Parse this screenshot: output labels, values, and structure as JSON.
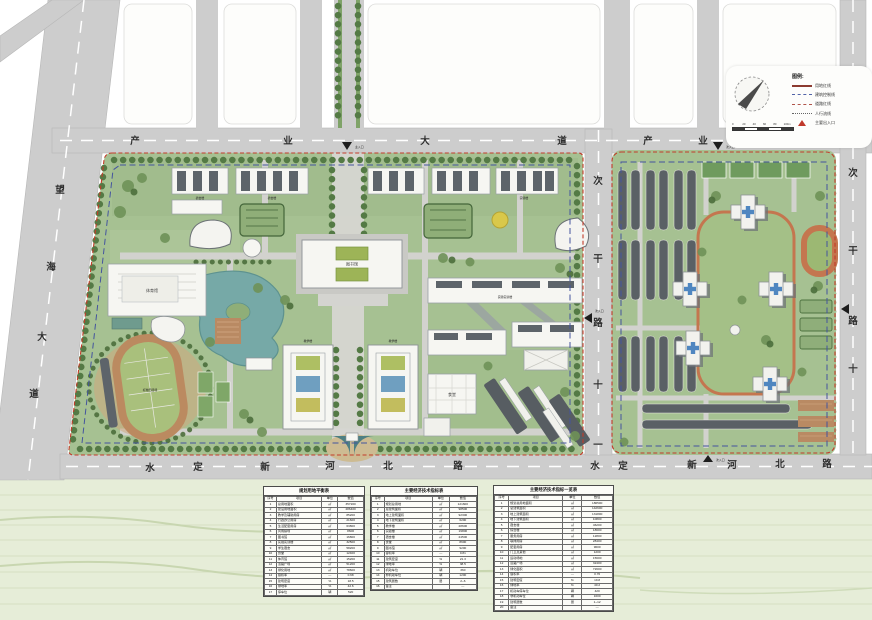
{
  "legend": {
    "title": "图例:",
    "items": [
      {
        "label": "用地红线",
        "type": "solid-red"
      },
      {
        "label": "建筑控制线",
        "type": "dash-blue"
      },
      {
        "label": "道路红线",
        "type": "dash-red"
      },
      {
        "label": "人行流线",
        "type": "dot-gray"
      },
      {
        "label": "主要出入口",
        "type": "tri-red"
      }
    ]
  },
  "scalebar": {
    "ticks": [
      "0",
      "20",
      "40",
      "60",
      "80",
      "100m"
    ]
  },
  "roads": {
    "chanye_west": {
      "chars": [
        "产",
        "业",
        "大",
        "道"
      ]
    },
    "chanye_east": {
      "chars": [
        "产",
        "业",
        "大",
        "道"
      ]
    },
    "wanghai": {
      "chars": [
        "望",
        "海",
        "大",
        "道"
      ]
    },
    "shuiding_west": {
      "chars": [
        "水",
        "定",
        "新",
        "河",
        "北",
        "路"
      ]
    },
    "shuiding_east": {
      "chars": [
        "水",
        "定",
        "新",
        "河",
        "北",
        "路"
      ]
    },
    "cigan11": {
      "chars": [
        "次",
        "干",
        "路",
        "十",
        "一"
      ]
    },
    "cigan10": {
      "chars": [
        "次",
        "干",
        "路",
        "十"
      ]
    }
  },
  "entrances": {
    "main": "主入口",
    "secondary": "次入口"
  },
  "building_labels": {
    "gym": "体育馆",
    "library": "图书馆",
    "stadium": "标准田径场",
    "lab": "实验实训楼",
    "teach_a": "教学楼",
    "teach_b": "教学楼",
    "canteen": "食堂",
    "dorm_a": "宿舍楼",
    "dorm_b": "宿舍楼",
    "dorm_c": "实验楼"
  },
  "tables": [
    {
      "title": "规划用地平衡表",
      "headers": [
        "序号",
        "项目",
        "单位",
        "数值"
      ],
      "rows": [
        [
          "1",
          "总用地面积",
          "㎡",
          "357200"
        ],
        [
          "2",
          "建设用地面积",
          "㎡",
          "286400"
        ],
        [
          "3",
          "教学及辅助用房",
          "㎡",
          "85200"
        ],
        [
          "4",
          "行政办公用房",
          "㎡",
          "21600"
        ],
        [
          "5",
          "生活配套用房",
          "㎡",
          "63800"
        ],
        [
          "6",
          "风雨操场",
          "㎡",
          "8600"
        ],
        [
          "7",
          "图书馆",
          "㎡",
          "16800"
        ],
        [
          "8",
          "实验实训楼",
          "㎡",
          "32500"
        ],
        [
          "9",
          "学生宿舍",
          "㎡",
          "58200"
        ],
        [
          "10",
          "食堂",
          "㎡",
          "12400"
        ],
        [
          "11",
          "体育馆",
          "㎡",
          "15200"
        ],
        [
          "12",
          "道路广场",
          "㎡",
          "51200"
        ],
        [
          "13",
          "绿化用地",
          "㎡",
          "78600"
        ],
        [
          "14",
          "容积率",
          "—",
          "0.68"
        ],
        [
          "15",
          "建筑密度",
          "%",
          "18.5"
        ],
        [
          "16",
          "绿地率",
          "%",
          "42.6"
        ],
        [
          "17",
          "停车位",
          "辆",
          "520"
        ]
      ]
    },
    {
      "title": "主要经济技术指标表",
      "headers": [
        "序号",
        "项目",
        "单位",
        "数值"
      ],
      "rows": [
        [
          "1",
          "规划总用地",
          "㎡",
          "121600"
        ],
        [
          "2",
          "总建筑面积",
          "㎡",
          "98500"
        ],
        [
          "3",
          "地上建筑面积",
          "㎡",
          "92300"
        ],
        [
          "4",
          "地下建筑面积",
          "㎡",
          "6200"
        ],
        [
          "5",
          "教学楼",
          "㎡",
          "28600"
        ],
        [
          "6",
          "实验楼",
          "㎡",
          "19800"
        ],
        [
          "7",
          "宿舍楼",
          "㎡",
          "24500"
        ],
        [
          "8",
          "食堂",
          "㎡",
          "8600"
        ],
        [
          "9",
          "图书馆",
          "㎡",
          "9200"
        ],
        [
          "10",
          "容积率",
          "—",
          "0.81"
        ],
        [
          "11",
          "建筑密度",
          "%",
          "21.3"
        ],
        [
          "12",
          "绿地率",
          "%",
          "38.5"
        ],
        [
          "13",
          "机动车位",
          "辆",
          "360"
        ],
        [
          "14",
          "非机动车位",
          "辆",
          "1200"
        ],
        [
          "15",
          "建筑层数",
          "层",
          "2~6"
        ],
        [
          "16",
          "备注",
          "",
          "—"
        ]
      ]
    },
    {
      "title": "主要经济技术指标一览表",
      "headers": [
        "序号",
        "项目",
        "单位",
        "数值"
      ],
      "rows": [
        [
          "1",
          "规划总用地面积",
          "㎡",
          "186500"
        ],
        [
          "2",
          "总建筑面积",
          "㎡",
          "142600"
        ],
        [
          "3",
          "地上建筑面积",
          "㎡",
          "131800"
        ],
        [
          "4",
          "地下建筑面积",
          "㎡",
          "10800"
        ],
        [
          "5",
          "宿舍楼",
          "㎡",
          "46200"
        ],
        [
          "6",
          "综合楼",
          "㎡",
          "18600"
        ],
        [
          "7",
          "服务用房",
          "㎡",
          "12800"
        ],
        [
          "8",
          "联排用房",
          "㎡",
          "28400"
        ],
        [
          "9",
          "配套用房",
          "㎡",
          "9600"
        ],
        [
          "10",
          "门卫及其他",
          "㎡",
          "1200"
        ],
        [
          "11",
          "运动场地",
          "㎡",
          "15600"
        ],
        [
          "12",
          "道路广场",
          "㎡",
          "32400"
        ],
        [
          "13",
          "绿化面积",
          "㎡",
          "72600"
        ],
        [
          "14",
          "容积率",
          "—",
          "0.76"
        ],
        [
          "15",
          "建筑密度",
          "%",
          "19.8"
        ],
        [
          "16",
          "绿地率",
          "%",
          "40.2"
        ],
        [
          "17",
          "机动车停车位",
          "辆",
          "420"
        ],
        [
          "18",
          "非机动车位",
          "辆",
          "1600"
        ],
        [
          "19",
          "建筑层数",
          "层",
          "1~12"
        ],
        [
          "20",
          "备注",
          "",
          "—"
        ]
      ]
    }
  ]
}
